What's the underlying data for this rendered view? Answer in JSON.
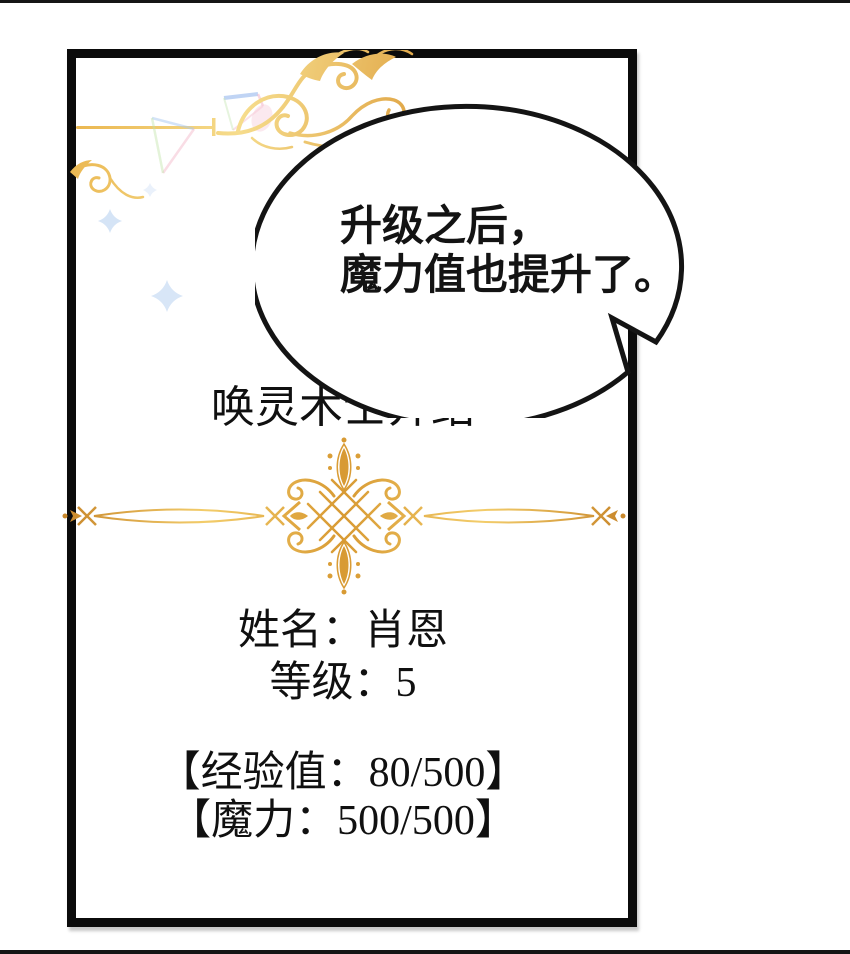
{
  "panel": {
    "title": "唤灵术士介绍",
    "speech_bubble": {
      "line1": "升级之后，",
      "line2": "魔力值也提升了。"
    },
    "stats": {
      "name_line": "姓名：肖恩",
      "level_line": "等级：5",
      "exp_line": "【经验值：80/500】",
      "mana_line": "【魔力：500/500】"
    }
  },
  "ornaments": {
    "top_flourish_icon": "gold-scroll-flourish",
    "left_curl_icon": "gold-curl",
    "divider_icon": "gold-filigree-divider",
    "sparkle_icons": [
      "pastel-triangle-sparkle",
      "four-point-star-sparkle"
    ]
  },
  "colors": {
    "ink": "#0B0B0B",
    "paper": "#FFFFFF",
    "gold_light": "#F6DC8C",
    "gold": "#EDAF44",
    "gold_dark": "#C9882B",
    "sparkle_blue": "#A9C8F0",
    "sparkle_pink": "#F2AFC4",
    "sparkle_green": "#BFE3A8"
  }
}
